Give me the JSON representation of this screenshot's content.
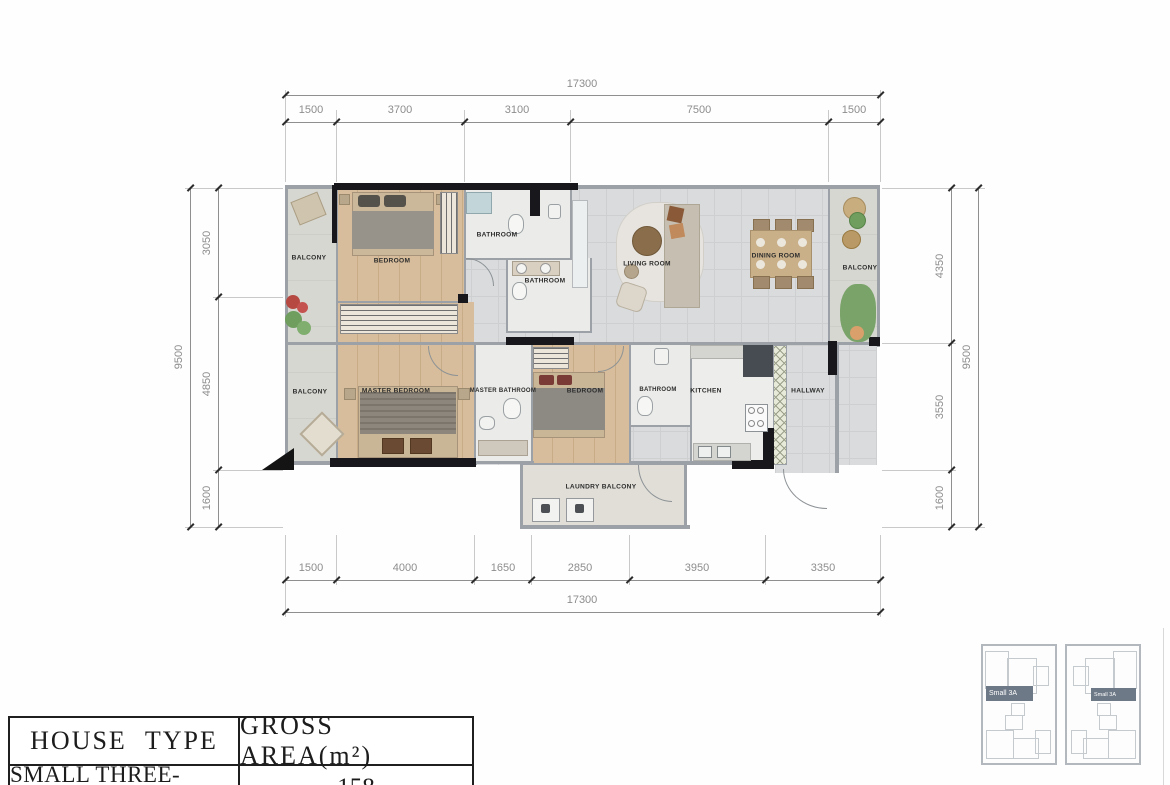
{
  "dims": {
    "top_total": "17300",
    "top_seg": [
      "1500",
      "3700",
      "3100",
      "7500",
      "1500"
    ],
    "bottom_total": "17300",
    "bottom_seg": [
      "1500",
      "4000",
      "1650",
      "2850",
      "3950",
      "3350"
    ],
    "left_total": "9500",
    "left_seg": [
      "3050",
      "4850",
      "1600"
    ],
    "right_total": "9500",
    "right_seg": [
      "4350",
      "3550",
      "1600"
    ]
  },
  "rooms": {
    "balcony_top_left": "BALCONY",
    "bedroom1": "BEDROOM",
    "bathroom1": "BATHROOM",
    "bathroom2": "BATHROOM",
    "living": "LIVING ROOM",
    "dining": "DINING ROOM",
    "balcony_right": "BALCONY",
    "balcony_mid_left": "BALCONY",
    "master_bedroom": "MASTER BEDROOM",
    "master_bathroom": "MASTER BATHROOM",
    "bedroom2": "BEDROOM",
    "bathroom3": "BATHROOM",
    "kitchen": "KITCHEN",
    "hallway": "HALLWAY",
    "laundry": "LAUNDRY BALCONY"
  },
  "table": {
    "house_type_header": "HOUSE TYPE",
    "gross_area_header": "GROSS AREA(m²)",
    "house_type_value": "SMALL THREE-BEDROOM-A",
    "gross_area_value": "158"
  },
  "keyplan": {
    "left_unit_label": "Small 3A",
    "right_unit_label": "Small 3A"
  }
}
